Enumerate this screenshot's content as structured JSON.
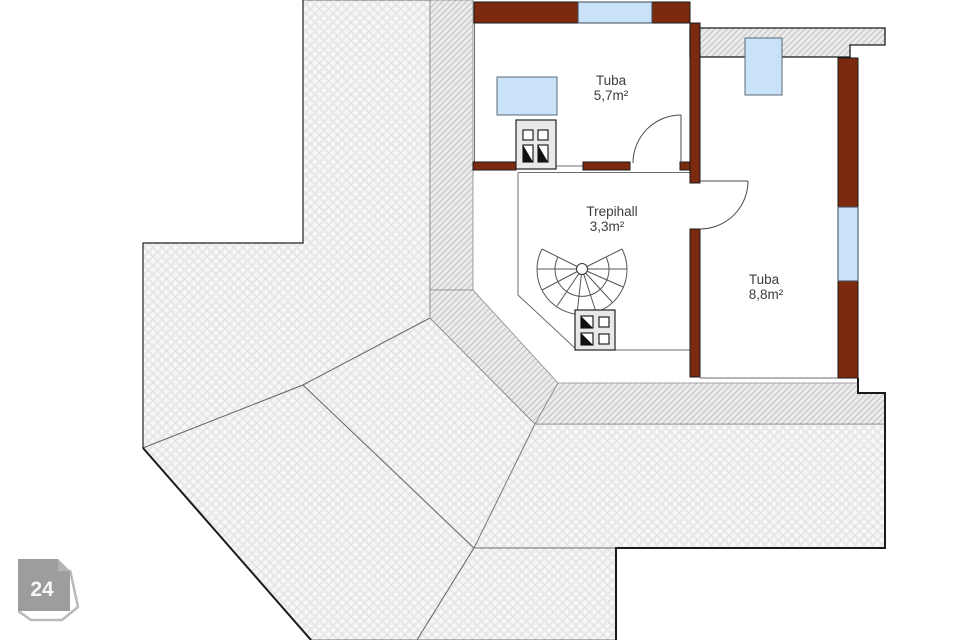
{
  "plan": {
    "rooms": [
      {
        "name": "Tuba",
        "area": "5,7m²"
      },
      {
        "name": "Trepihall",
        "area": "3,3m²"
      },
      {
        "name": "Tuba",
        "area": "8,8m²"
      }
    ],
    "badge": {
      "number": "24"
    },
    "colors": {
      "wall": "#7b2a10",
      "window": "#c9e2f8",
      "roof_bg": "#f8f8f8",
      "roof_dot": "#e4e4e4",
      "hatch_bg": "#ebebeb",
      "hatch_line": "#c2c2c2",
      "badge_fill": "#9d9d9d",
      "badge_back": "#b9b9b9"
    }
  }
}
